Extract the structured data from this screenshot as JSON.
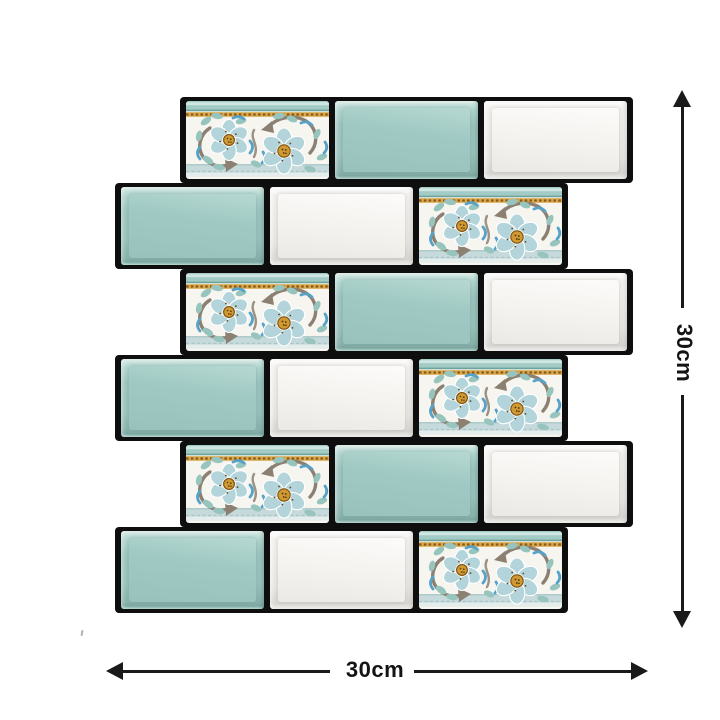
{
  "mosaic": {
    "rows": [
      {
        "indent": "right",
        "tiles": [
          "floral",
          "teal",
          "white"
        ]
      },
      {
        "indent": "left",
        "tiles": [
          "teal",
          "white",
          "floral"
        ]
      },
      {
        "indent": "right",
        "tiles": [
          "floral",
          "teal",
          "white"
        ]
      },
      {
        "indent": "left",
        "tiles": [
          "teal",
          "white",
          "floral"
        ]
      },
      {
        "indent": "right",
        "tiles": [
          "floral",
          "teal",
          "white"
        ]
      },
      {
        "indent": "left",
        "tiles": [
          "teal",
          "white",
          "floral"
        ]
      }
    ],
    "colors": {
      "grout": "#0e0e0e",
      "teal_face": "#a0c9c3",
      "white_face": "#f4f2ef",
      "floral_background": "#f7f5f0",
      "band_teal": "#a3cbc5",
      "band_gold": "#d9a94e",
      "band_bottom": "#c6dadc",
      "petal": "#b2d4da",
      "flower_center": "#cf9a33",
      "leaf": "#97c5bd",
      "stem": "#8b8071",
      "crescent": "#57a2c8"
    }
  },
  "dimensions": {
    "height": {
      "label": "30cm"
    },
    "width": {
      "label": "30cm"
    },
    "arrow_color": "#1a1a1a"
  }
}
